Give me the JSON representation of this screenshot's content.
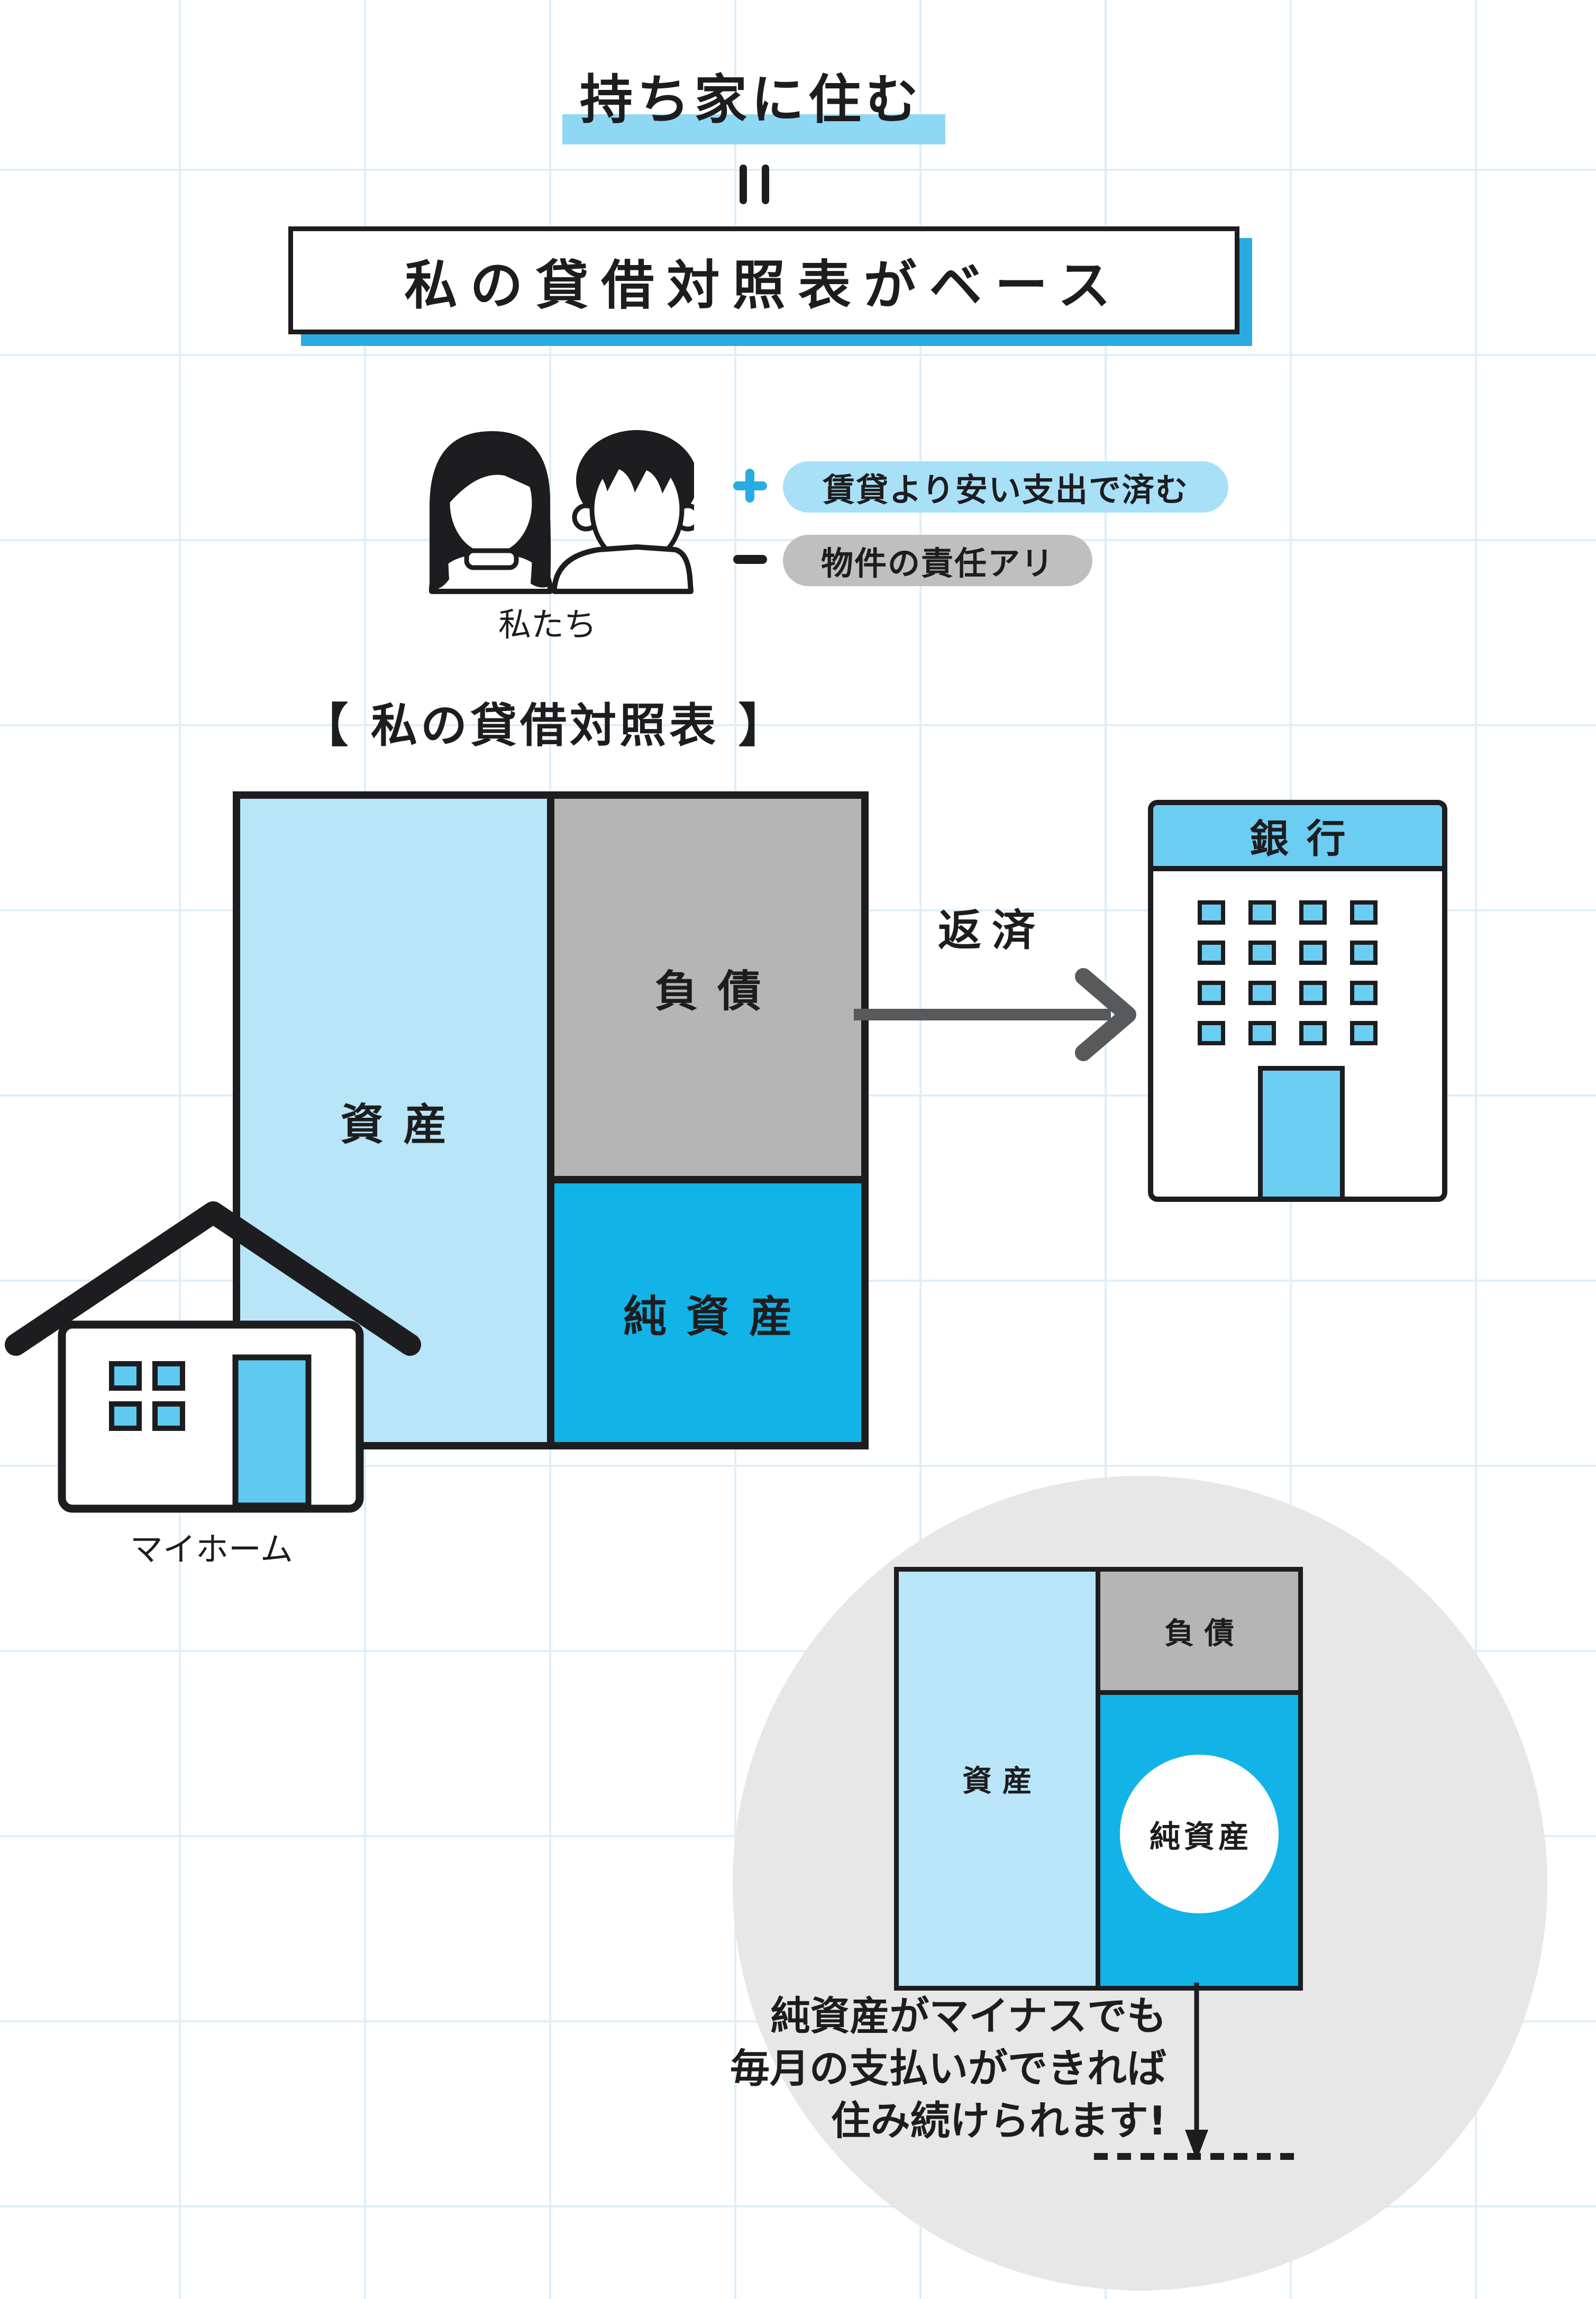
{
  "colors": {
    "accent_cyan": "#29ABE2",
    "title_highlight_blue": "#8FD8F4",
    "pro_pill_blue": "#A8E0F8",
    "con_pill_gray": "#BFBFBF",
    "assets_light_blue": "#B8E5F8",
    "liabilities_gray": "#B5B5B5",
    "net_assets_cyan": "#12B3E6",
    "bank_blue": "#6CCDF2",
    "house_blue": "#5FC9F0",
    "future_circle_gray": "#E7E7E7",
    "repay_arrow_gray": "#58595B",
    "ink": "#1D1D1F",
    "grid_blue": "#DFEEF9"
  },
  "header": {
    "title": "持ち家に住む",
    "boxed_subtitle": "私の貸借対照表がベース"
  },
  "couple": {
    "label": "私たち",
    "pro": "賃貸より安い支出で済む",
    "con": "物件の責任アリ"
  },
  "main_balance_sheet": {
    "heading": "【 私の貸借対照表 】",
    "assets": "資産",
    "liabilities": "負債",
    "net_assets": "純資産",
    "repayment_label": "返済"
  },
  "bank": {
    "label": "銀行"
  },
  "house": {
    "label": "マイホーム"
  },
  "future_view": {
    "assets": "資産",
    "liabilities": "負債",
    "net_assets": "純資産",
    "note_lines": [
      "純資産がマイナスでも",
      "毎月の支払いができれば",
      "住み続けられます!"
    ]
  }
}
